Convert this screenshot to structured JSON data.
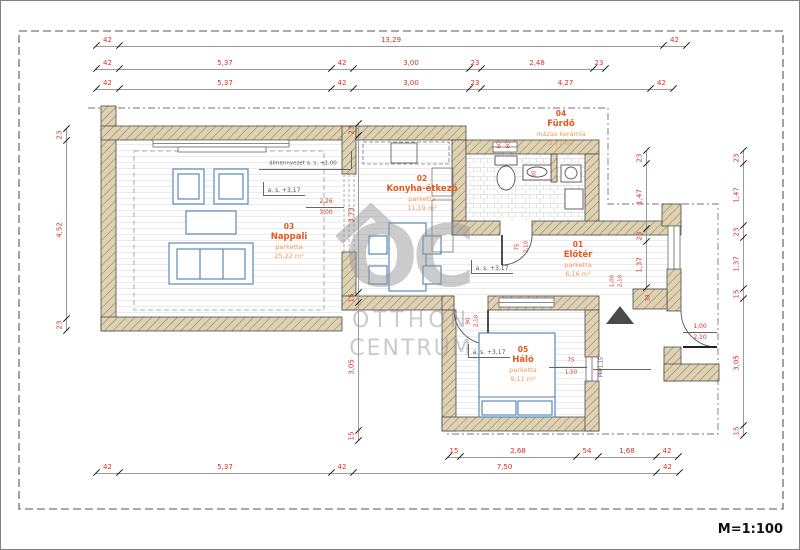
{
  "scale_label": "M=1:100",
  "watermark": {
    "logo": "OC",
    "line1": "OTTHON",
    "line2": "CENTRUM"
  },
  "rooms": [
    {
      "num": "03",
      "name": "Nappali",
      "material": "parketta",
      "area": "25,22 m²",
      "cx": 288,
      "cy": 222
    },
    {
      "num": "02",
      "name": "Konyha-étkező",
      "material": "parketta",
      "area": "11,19 m²",
      "cx": 421,
      "cy": 174
    },
    {
      "num": "04",
      "name": "Fürdő",
      "material": "mázas kerámia",
      "area": "3,77 m²",
      "cx": 560,
      "cy": 109
    },
    {
      "num": "01",
      "name": "Előtér",
      "material": "parketta",
      "area": "6,16 m²",
      "cx": 577,
      "cy": 240
    },
    {
      "num": "05",
      "name": "Háló",
      "material": "parketta",
      "area": "9,11 m²",
      "cx": 522,
      "cy": 345
    }
  ],
  "h_dims": [
    {
      "y": 45,
      "pts": [
        95,
        118,
        662,
        685
      ],
      "labels": [
        "42",
        "13,29",
        "42"
      ]
    },
    {
      "y": 68,
      "pts": [
        95,
        118,
        330,
        352,
        468,
        480,
        592,
        604
      ],
      "labels": [
        "42",
        "5,37",
        "42",
        "3,00",
        "23",
        "2,48",
        "23"
      ]
    },
    {
      "y": 88,
      "pts": [
        95,
        118,
        330,
        352,
        468,
        480,
        649,
        672
      ],
      "labels": [
        "42",
        "5,37",
        "42",
        "3,00",
        "23",
        "4,27",
        "42"
      ]
    },
    {
      "y": 456,
      "pts": [
        447,
        459,
        575,
        597,
        655,
        677
      ],
      "labels": [
        "15",
        "2,68",
        "54",
        "1,68",
        "42"
      ]
    },
    {
      "y": 472,
      "pts": [
        95,
        118,
        330,
        352,
        655,
        678
      ],
      "labels": [
        "42",
        "5,37",
        "42",
        "7,50",
        "42"
      ]
    }
  ],
  "v_dims": [
    {
      "x": 65,
      "pts": [
        128,
        140,
        318,
        330
      ],
      "labels": [
        "23",
        "4,52",
        "23"
      ]
    },
    {
      "x": 357,
      "pts": [
        123,
        135,
        292,
        302,
        430,
        440
      ],
      "labels": [
        "23",
        "3,73",
        "15",
        "3,05",
        "15"
      ]
    },
    {
      "x": 645,
      "pts": [
        150,
        163,
        228,
        241,
        287
      ],
      "labels": [
        "23",
        "1,47",
        "23",
        "1,37"
      ]
    },
    {
      "x": 742,
      "pts": [
        150,
        163,
        225,
        237,
        288,
        298,
        425,
        435
      ],
      "labels": [
        "23",
        "1,47",
        "23",
        "1,37",
        "15",
        "3,05",
        "15"
      ]
    }
  ],
  "annotations": [
    {
      "t": "álmennyezet a. s. +1,00",
      "x": 302,
      "y": 163,
      "s": 5.5,
      "c": "gray"
    },
    {
      "t": "a. s. +3,17",
      "x": 283,
      "y": 190,
      "s": 6,
      "c": "gray"
    },
    {
      "t": "a. s. +3,17",
      "x": 491,
      "y": 268,
      "s": 6,
      "c": "gray"
    },
    {
      "t": "a. s. +3,17",
      "x": 488,
      "y": 352,
      "s": 6,
      "c": "gray"
    },
    {
      "t": "2,26",
      "x": 325,
      "y": 201,
      "s": 6,
      "c": "red"
    },
    {
      "t": "3,00",
      "x": 325,
      "y": 212,
      "s": 6,
      "c": "red"
    },
    {
      "t": "60",
      "x": 499,
      "y": 144,
      "s": 5.5,
      "c": "red",
      "r": 1
    },
    {
      "t": "60",
      "x": 508,
      "y": 144,
      "s": 5.5,
      "c": "red",
      "r": 1
    },
    {
      "t": "80",
      "x": 534,
      "y": 173,
      "s": 5.5,
      "c": "red",
      "r": 1
    },
    {
      "t": "75",
      "x": 517,
      "y": 246,
      "s": 5.5,
      "c": "red",
      "r": 1
    },
    {
      "t": "2,10",
      "x": 526,
      "y": 246,
      "s": 5.5,
      "c": "red",
      "r": 1
    },
    {
      "t": "90",
      "x": 468,
      "y": 320,
      "s": 5.5,
      "c": "red",
      "r": 1
    },
    {
      "t": "2,10",
      "x": 476,
      "y": 320,
      "s": 5.5,
      "c": "red",
      "r": 1
    },
    {
      "t": "75",
      "x": 570,
      "y": 360,
      "s": 5.5,
      "c": "red"
    },
    {
      "t": "1,50",
      "x": 570,
      "y": 372,
      "s": 5.5,
      "c": "red"
    },
    {
      "t": "PM/1,15",
      "x": 601,
      "y": 366,
      "s": 5,
      "c": "gray",
      "r": 1
    },
    {
      "t": "1,00",
      "x": 612,
      "y": 280,
      "s": 5.5,
      "c": "red",
      "r": 1
    },
    {
      "t": "2,10",
      "x": 620,
      "y": 280,
      "s": 5.5,
      "c": "red",
      "r": 1
    },
    {
      "t": "38",
      "x": 648,
      "y": 297,
      "s": 5.5,
      "c": "red",
      "r": 1
    },
    {
      "t": "1,00",
      "x": 699,
      "y": 326,
      "s": 6,
      "c": "red"
    },
    {
      "t": "2,10",
      "x": 699,
      "y": 337,
      "s": 6,
      "c": "red"
    }
  ],
  "lines": [
    {
      "x1": 258,
      "y1": 168,
      "x2": 350,
      "y2": 168
    },
    {
      "x1": 350,
      "y1": 150,
      "x2": 350,
      "y2": 168
    },
    {
      "x1": 262,
      "y1": 194,
      "x2": 304,
      "y2": 194
    },
    {
      "x1": 262,
      "y1": 181,
      "x2": 262,
      "y2": 194
    },
    {
      "x1": 470,
      "y1": 272,
      "x2": 512,
      "y2": 272
    },
    {
      "x1": 470,
      "y1": 259,
      "x2": 470,
      "y2": 272
    },
    {
      "x1": 467,
      "y1": 356,
      "x2": 509,
      "y2": 356
    },
    {
      "x1": 467,
      "y1": 343,
      "x2": 467,
      "y2": 356
    },
    {
      "x1": 305,
      "y1": 206,
      "x2": 343,
      "y2": 206
    },
    {
      "x1": 682,
      "y1": 331,
      "x2": 716,
      "y2": 331
    },
    {
      "x1": 548,
      "y1": 366,
      "x2": 586,
      "y2": 366
    },
    {
      "x1": 592,
      "y1": 368,
      "x2": 650,
      "y2": 368
    }
  ]
}
